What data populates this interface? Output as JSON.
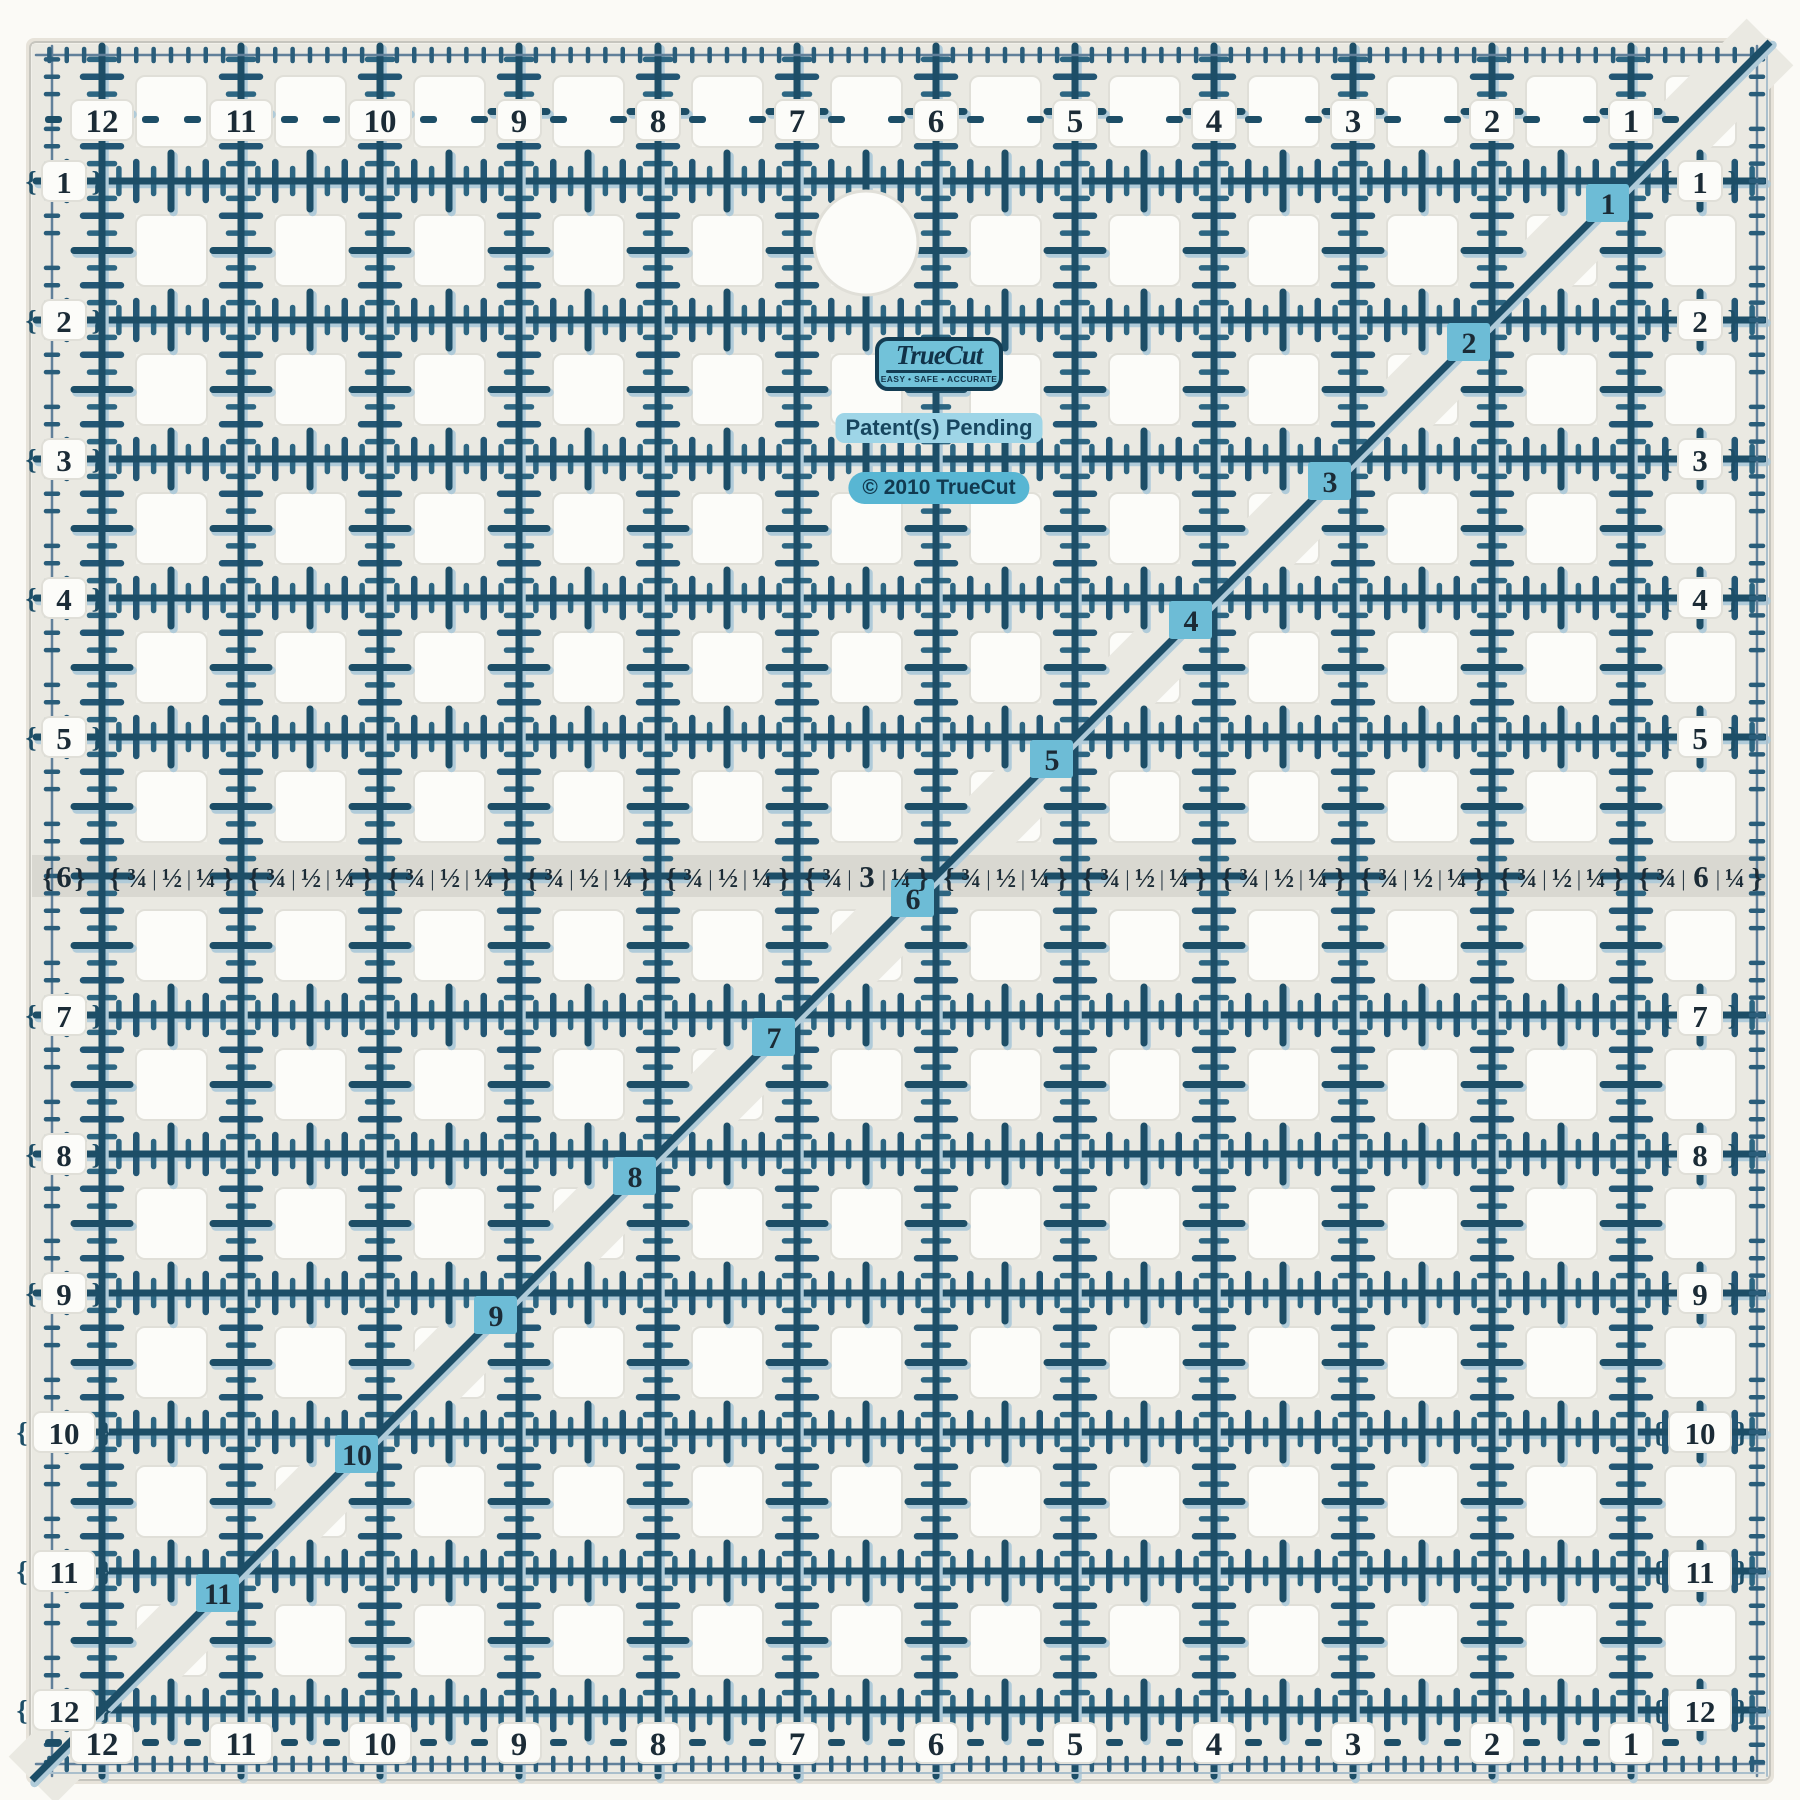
{
  "ruler": {
    "top_numbers": [
      "12",
      "11",
      "10",
      "9",
      "8",
      "7",
      "6",
      "5",
      "4",
      "3",
      "2",
      "1"
    ],
    "bottom_numbers": [
      "12",
      "11",
      "10",
      "9",
      "8",
      "7",
      "6",
      "5",
      "4",
      "3",
      "2",
      "1"
    ],
    "left_numbers": [
      "1",
      "2",
      "3",
      "4",
      "5",
      "7",
      "8",
      "9",
      "10",
      "11",
      "12"
    ],
    "right_numbers": [
      "1",
      "2",
      "3",
      "4",
      "5",
      "7",
      "8",
      "9",
      "10",
      "11",
      "12"
    ],
    "diagonal_numbers": [
      "1",
      "2",
      "3",
      "4",
      "5",
      "6",
      "7",
      "8",
      "9",
      "10",
      "11"
    ],
    "row6_left_label": "6",
    "fraction_segments": [
      [
        "¾",
        "½",
        "¼"
      ],
      [
        "¾",
        "½",
        "¼"
      ],
      [
        "¾",
        "½",
        "¼"
      ],
      [
        "¾",
        "½",
        "¼"
      ],
      [
        "¾",
        "½",
        "¼"
      ],
      [
        "¾",
        "3",
        "¼"
      ],
      [
        "¾",
        "½",
        "¼"
      ],
      [
        "¾",
        "½",
        "¼"
      ],
      [
        "¾",
        "½",
        "¼"
      ],
      [
        "¾",
        "½",
        "¼"
      ],
      [
        "¾",
        "½",
        "¼"
      ],
      [
        "¾",
        "6",
        "¼"
      ]
    ],
    "fraction_separator": "|",
    "bracket_left": "{",
    "bracket_right": "}"
  },
  "branding": {
    "logo_text": "TrueCut",
    "tagline": "EASY • SAFE • ACCURATE",
    "patent": "Patent(s) Pending",
    "copyright": "© 2010 TrueCut"
  },
  "colors": {
    "page_bg": "#fbfaf6",
    "body": "#f1f0ea",
    "street": "#eae9e2",
    "hole": "#fcfcf9",
    "hole_edge": "#e0dfd8",
    "strip": "#d9d8d1",
    "line_navy": "#1d4e67",
    "line_mid": "#235674",
    "line_soft": "#2d6682",
    "line_light": "#b0cbd9",
    "edge_line": "#61809a",
    "edge_dash": "#2a5d7a",
    "edge_thin": "#aabfcc",
    "digit": "#1b2b36",
    "teal_badge": "#6dbcd6",
    "logo_fill": "#72c2d9",
    "logo_navy": "#133d53",
    "patent_highlight": "#9ed5e7",
    "copyright_fill": "#58b6d3",
    "ruler_border": "#c6c5be"
  }
}
